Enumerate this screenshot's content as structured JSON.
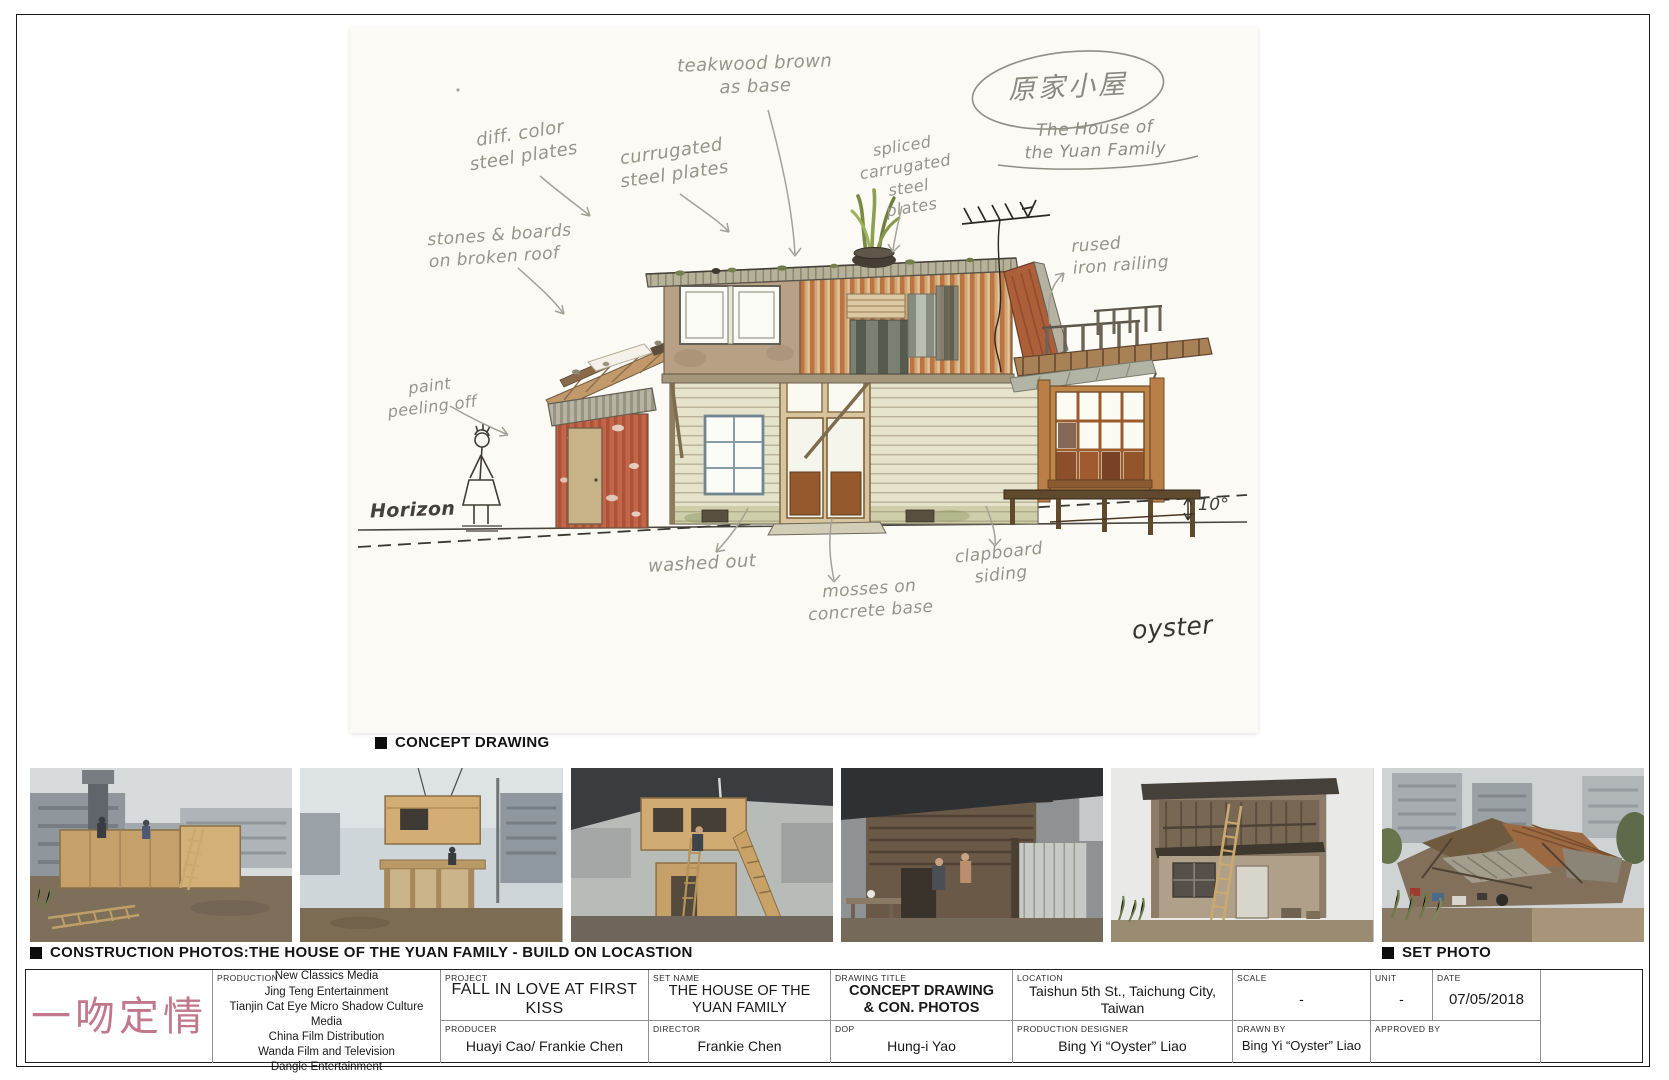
{
  "captions": {
    "concept": "CONCEPT DRAWING",
    "construction": "CONSTRUCTION PHOTOS:THE HOUSE OF THE YUAN FAMILY - BUILD ON LOCASTION",
    "set_photo": "SET PHOTO"
  },
  "drawing": {
    "annotations": {
      "teakwood": "teakwood brown\nas base",
      "diff_color": "diff. color\nsteel plates",
      "corrugated": "currugated\nsteel plates",
      "spliced": "spliced\ncarrugated steel\nplates",
      "stones": "stones & boards\non broken roof",
      "rusted": "rused\niron railing",
      "paint": "paint\npeeling off",
      "horizon": "Horizon",
      "washed": "washed out",
      "mosses": "mosses on\nconcrete base",
      "clapboard": "clapboard\nsiding",
      "angle": "10°",
      "signature": "oyster",
      "house_title_zh": "原家小屋",
      "house_title_en": "The House of\nthe Yuan Family"
    }
  },
  "titleblock": {
    "logo": "一吻定情",
    "production": {
      "label": "PRODUCTION",
      "companies": "New Classics Media\nJing Teng Entertainment\nTianjin Cat Eye Micro Shadow Culture Media\nChina Film Distribution\nWanda Film and Television\nDangle Entertainment"
    },
    "project": {
      "label": "PROJECT",
      "value": "FALL IN LOVE AT FIRST KISS"
    },
    "set_name": {
      "label": "SET NAME",
      "value": "THE HOUSE OF THE\nYUAN FAMILY"
    },
    "drawing_title": {
      "label": "DRAWING TITLE",
      "value": "CONCEPT DRAWING\n& CON. PHOTOS"
    },
    "location": {
      "label": "LOCATION",
      "value": "Taishun 5th St., Taichung City, Taiwan"
    },
    "scale": {
      "label": "SCALE",
      "value": "-"
    },
    "unit": {
      "label": "UNIT",
      "value": "-"
    },
    "date": {
      "label": "DATE",
      "value": "07/05/2018"
    },
    "producer": {
      "label": "PRODUCER",
      "value": "Huayi Cao/ Frankie Chen"
    },
    "director": {
      "label": "DIRECTOR",
      "value": "Frankie Chen"
    },
    "dop": {
      "label": "DOP",
      "value": "Hung-i Yao"
    },
    "production_designer": {
      "label": "PRODUCTION DESIGNER",
      "value": "Bing Yi “Oyster” Liao"
    },
    "drawn_by": {
      "label": "DRAWN BY",
      "value": "Bing Yi “Oyster” Liao"
    },
    "approved_by": {
      "label": "APPROVED BY",
      "value": ""
    }
  }
}
